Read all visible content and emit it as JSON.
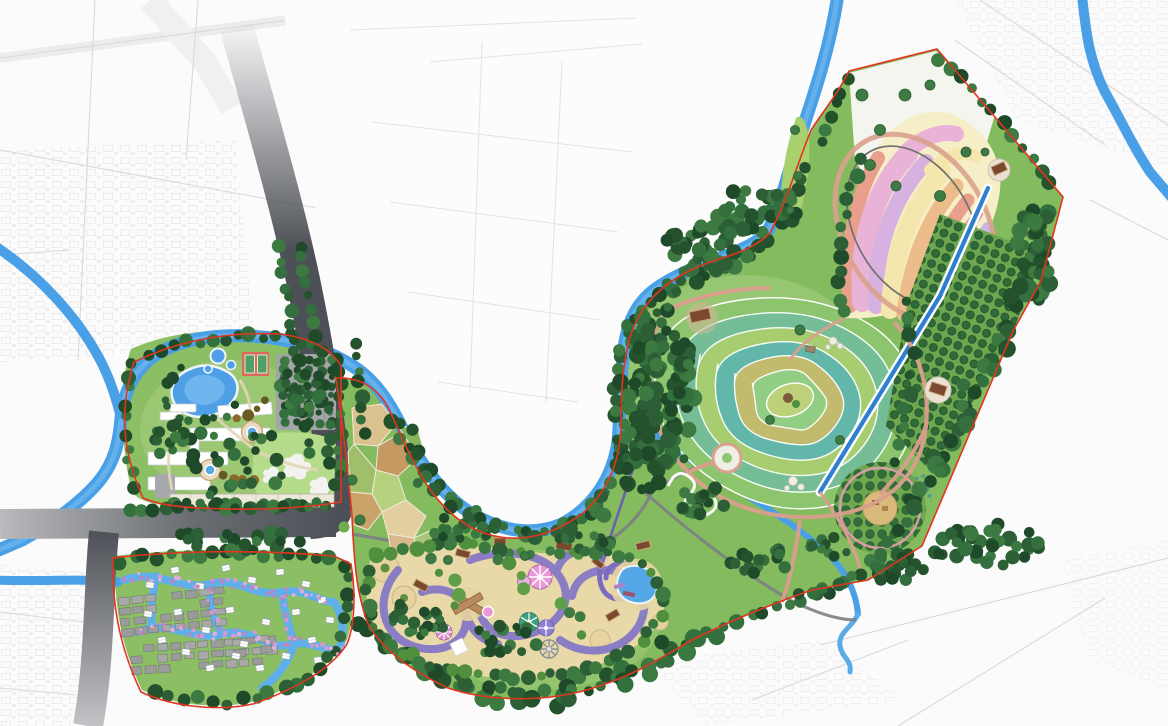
{
  "document": {
    "kind": "landscape-master-plan-rendering",
    "title": "Riverside Park Master Plan",
    "has_text_labels": false
  },
  "map": {
    "palette": {
      "background": "#fbfbfc",
      "water": "#4aa0e6",
      "water_deep": "#2e7fd0",
      "road_dark": "#4d5056",
      "road_light": "#c6c7c9",
      "boundary_red": "#e2351f",
      "park_green": "#85bb5f",
      "lawn_green": "#a9d077",
      "forest_green": "#2c5f36",
      "amusement_ground": "#ead9a8",
      "ride_track_purple": "#8579c6",
      "flower_pink": "#e9b3d8",
      "flower_lilac": "#d7b2e0",
      "flower_yellow": "#f4e6ac",
      "flower_orange": "#ecbd8a",
      "flower_salmon": "#e8a08c",
      "meadow_teal": "#74bd9a",
      "meadow_olive": "#c8bc6b",
      "village_gray": "#9b9b9b",
      "villa_white": "#ffffff",
      "path_pink": "#dc9f8e",
      "city_line_gray": "#d9d9dc"
    },
    "regions": [
      {
        "id": "west-leisure-garden",
        "features": [
          "kidney-pond",
          "tennis-courts",
          "white-pavilion-buildings",
          "fountain-circles",
          "tree-lined-parking",
          "lawn-with-clearings",
          "shopfront-strip"
        ]
      },
      {
        "id": "waterfront-villa-village",
        "features": [
          "winding-canals",
          "white-villas",
          "flowering-banks",
          "existing-village-gray-blocks"
        ]
      },
      {
        "id": "amusement-park",
        "features": [
          "ride-track-loops",
          "carousel-discs",
          "ferris-wheel",
          "splash-pond",
          "x-shaped-pavilion",
          "coaster-zipline"
        ]
      },
      {
        "id": "farm-patchwork-fields"
      },
      {
        "id": "meadow-swirl-patchwork"
      },
      {
        "id": "flower-field-swirls"
      },
      {
        "id": "orchards"
      },
      {
        "id": "north-meadow-clearing"
      },
      {
        "id": "rivers-and-straight-canal"
      },
      {
        "id": "city-road-network",
        "features": [
          "curved-arterial-road",
          "west-arterial-road",
          "south-arterial-road",
          "faint-city-blocks"
        ]
      }
    ]
  }
}
